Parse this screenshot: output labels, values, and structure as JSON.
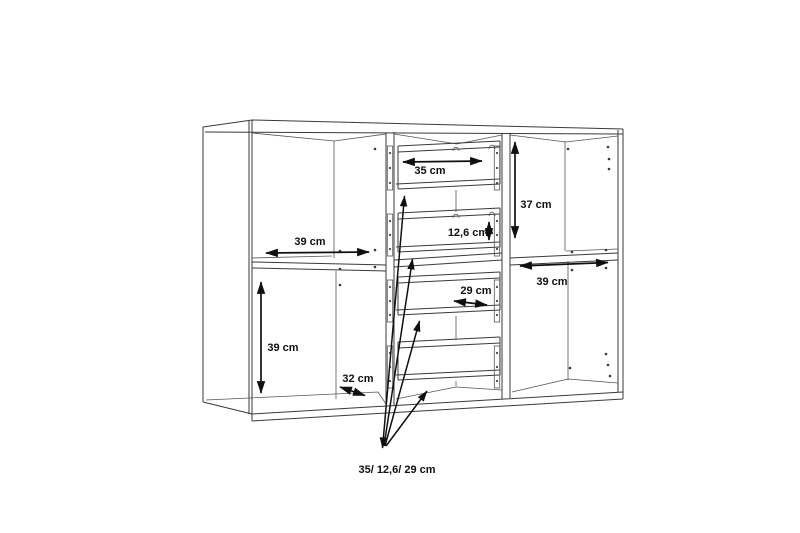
{
  "drawing": {
    "type": "furniture-dimension-diagram",
    "subject": "sideboard cabinet wireframe with two door sections and four-drawer middle column",
    "background_color": "#ffffff",
    "line_color": "#3a3a3a",
    "dimension_color": "#101010",
    "unit": "cm",
    "annotations": [
      {
        "name": "left-top-compartment-width",
        "text": "39 cm"
      },
      {
        "name": "left-bottom-compartment-height",
        "text": "39 cm"
      },
      {
        "name": "left-bottom-compartment-depth",
        "text": "32 cm"
      },
      {
        "name": "top-drawer-width",
        "text": "35 cm"
      },
      {
        "name": "middle-drawer-height",
        "text": "12,6 cm"
      },
      {
        "name": "lower-drawer-width",
        "text": "29 cm"
      },
      {
        "name": "right-top-compartment-height",
        "text": "37 cm"
      },
      {
        "name": "right-shelf-width",
        "text": "39 cm"
      },
      {
        "name": "drawer-stack-dimensions",
        "text": "35/ 12,6/ 29 cm"
      }
    ]
  }
}
